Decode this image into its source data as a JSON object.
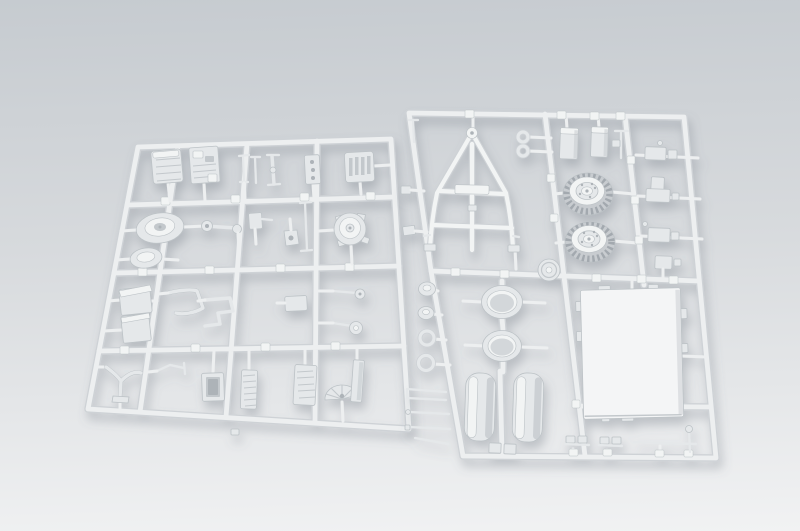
{
  "scene": {
    "type": "product-photograph",
    "description": "Two light-grey injection-moulded plastic model kit sprues (runners full of unassembled trailer parts) photographed flat on a pale grey studio background with soft shadows",
    "background": "plain studio sweep, grey gradient darker at top and brighter at bottom",
    "item_count": 2
  },
  "colors": {
    "background_top": "#c6cbd0",
    "background_mid": "#d7dadd",
    "background_bottom": "#f1f2f3",
    "rail_core": "#edeff0",
    "rail_edge": "#ced2d6",
    "plastic_light": "#f2f4f4",
    "plastic_mid": "#e5e8ea",
    "plastic_shade": "#c3c8cc",
    "plastic_edge": "#bcc2c6",
    "tread": "#c8ccd0",
    "tread_dark": "#a3a9af",
    "panel_white": "#f4f5f6",
    "hole": "#adb3b8",
    "ring_hole": "#d3d7da",
    "shadow": "#66707c"
  },
  "sprues": {
    "left": {
      "id": "sprue-a",
      "position": "left, tilted slightly",
      "grid": "4 rows x 4 columns of runners",
      "approx_part_count": 34,
      "notable_parts": [
        "ribbed fender block",
        "engine block",
        "T-rod pins",
        "plate with holes",
        "slotted box",
        "cover drums",
        "axle with hub",
        "small brackets",
        "differential housing",
        "stacked stowage boxes",
        "bent tow rod",
        "step bracket",
        "rod-and-disc axles",
        "wishbone bracket",
        "control lever",
        "open stowage box",
        "ribbed racks",
        "ribbed fan guard",
        "side plate"
      ]
    },
    "right": {
      "id": "sprue-b",
      "position": "right, slightly taller",
      "grid": "3 columns with crossing runners",
      "approx_part_count": 28,
      "notable_parts": [
        "A-frame drawbar",
        "tow eye rings x2",
        "stowage boxes x2",
        "treaded road wheels x2",
        "round mold stamp disc",
        "hub discs x2",
        "hub rings x2",
        "wheel rim rings x2",
        "tire halves x2",
        "large floor panel with tabs",
        "linkage pin cluster",
        "small bracket clusters x4",
        "tie rod",
        "clamps x2"
      ]
    }
  }
}
